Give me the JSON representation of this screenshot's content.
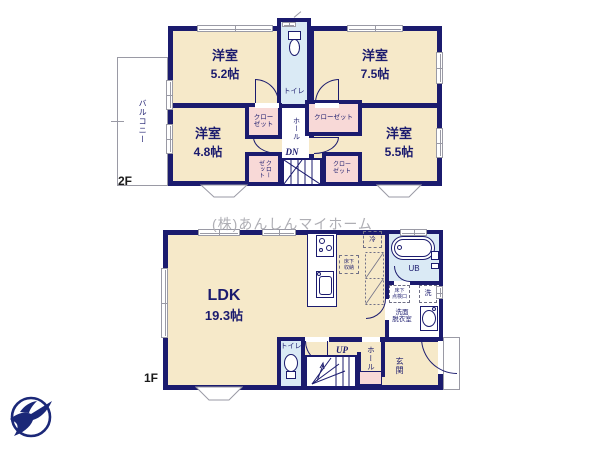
{
  "colors": {
    "navy": "#1b1b6e",
    "cream": "#f6e9c9",
    "pink": "#f8d9d7",
    "blue": "#daeaf5",
    "winline": "#9a9aa5",
    "watermark": "#aeaeb4",
    "logo": "#1b2878",
    "floorlabel": "#1a1a1a"
  },
  "watermark_text": "(株)あんしんマイホーム",
  "floor2": {
    "label": "2F",
    "balcony": "バルコニー",
    "toilet": "トイレ",
    "hall": "ホール",
    "stairs": "DN",
    "room_tl": {
      "name": "洋室",
      "size": "5.2帖"
    },
    "room_tr": {
      "name": "洋室",
      "size": "7.5帖"
    },
    "room_bl": {
      "name": "洋室",
      "size": "4.8帖"
    },
    "room_br": {
      "name": "洋室",
      "size": "5.5帖"
    },
    "closet_left": "クロー\nゼット",
    "closet_right": "クローゼット",
    "closet_bottom_left": "クロー\nゼット",
    "closet_bottom_right": "クロー\nゼット"
  },
  "floor1": {
    "label": "1F",
    "ldk_name": "LDK",
    "ldk_size": "19.3帖",
    "toilet": "トイレ",
    "stairs": "UP",
    "hall": "ホール",
    "entrance": "玄関",
    "unit_bath": "UB",
    "washroom": "洗面\n脱衣室",
    "fridge": "冷",
    "underfloor_storage": "床下\n収納",
    "underfloor_hatch": "床下\n点検口",
    "washer": "洗"
  }
}
